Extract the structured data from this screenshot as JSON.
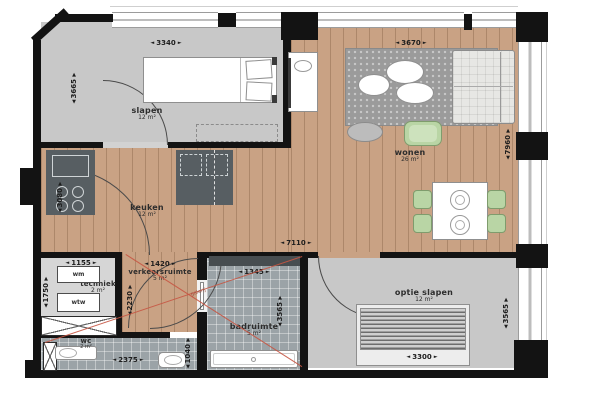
{
  "plan": {
    "rooms": {
      "slapen": {
        "name": "slapen",
        "area": "12 m²"
      },
      "wonen": {
        "name": "wonen",
        "area": "26 m²"
      },
      "keuken": {
        "name": "keuken",
        "area": "12 m²"
      },
      "verkeersruimte": {
        "name": "verkeersruimte",
        "area": "5 m²"
      },
      "techniek": {
        "name": "techniek",
        "area": "2 m²"
      },
      "badruimte": {
        "name": "badruimte",
        "area": "5 m²"
      },
      "wc": {
        "name": "wc",
        "area": "2 m²"
      },
      "optie_slapen": {
        "name": "optie slapen",
        "area": "12 m²"
      }
    },
    "appliances": {
      "wm": "wm",
      "wtw": "wtw"
    },
    "dims": {
      "slapen_w": "3340",
      "slapen_h": "3665",
      "wonen_w": "3670",
      "wonen_h": "7960",
      "total_w": "7110",
      "keuken_h": "3080",
      "techniek_w": "1155",
      "techniek_h": "1750",
      "verkeer_w": "1420",
      "verkeer_h": "2230",
      "bad_w": "1345",
      "bad_h": "3565",
      "wc_w": "2375",
      "wc_h": "1040",
      "optie_bed_w": "3300",
      "optie_h": "3565"
    },
    "glyphs": {
      "left": "◄",
      "right": "►",
      "up": "▲",
      "down": "▼"
    },
    "route_label": "galerij",
    "colors": {
      "wall": "#131313",
      "wood": "#c9a284",
      "tile": "#9ba3a7",
      "gray_floor": "#c8c8c8",
      "counter": "#575e62",
      "accent_green": "#b9d5a5",
      "route_red": "#c65542"
    }
  }
}
